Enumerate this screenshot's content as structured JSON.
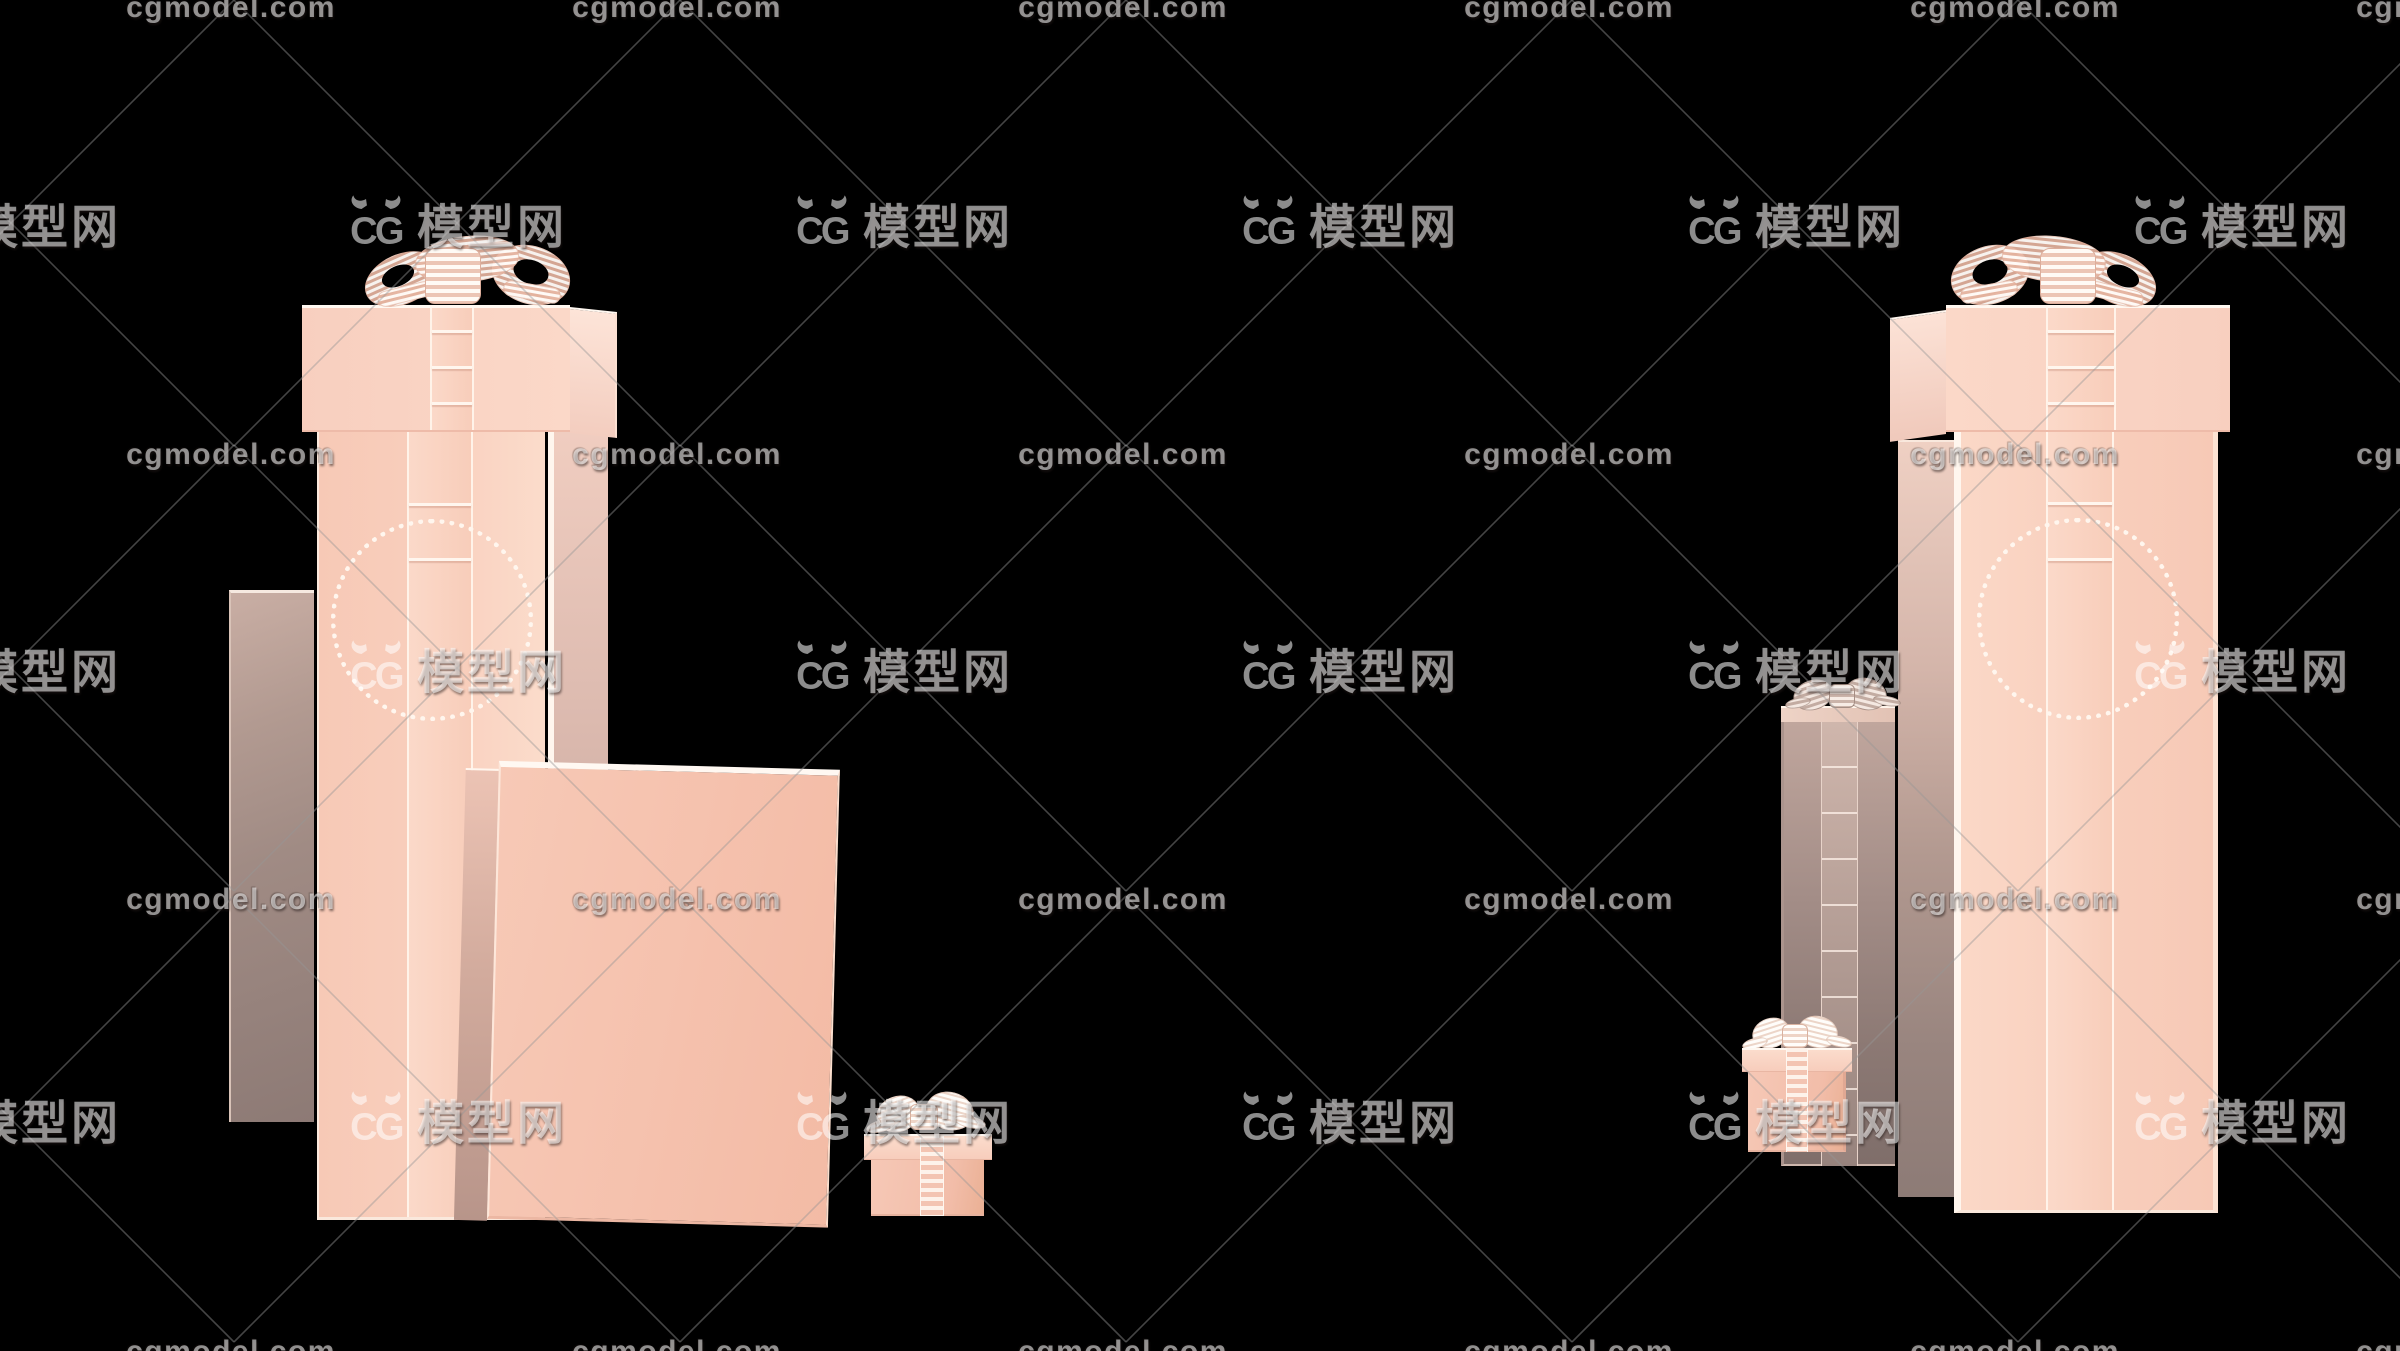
{
  "watermark": {
    "site_text": "cgmodel.com",
    "logo_monogram": "CG",
    "logo_text": "模型网",
    "fill_color": "rgba(255,255,255,0.55)",
    "line_color": "rgba(150,150,150,0.45)",
    "grid": {
      "canvas_w": 2400,
      "canvas_h": 1351,
      "col_step": 446,
      "cols": 6,
      "text_col_start": 231,
      "logo_col_start": 11,
      "text_rows": [
        8,
        455,
        900,
        1352
      ],
      "logo_rows": [
        223,
        668,
        1119
      ],
      "half_cell_h": 223
    }
  },
  "scene": {
    "background": "#000000",
    "objects_left_group": [
      "backdrop-panel",
      "tall-gift-box-with-bow",
      "flat-gift-box",
      "mini-gift-box"
    ],
    "objects_right_group": [
      "gray-gift-box-with-bow",
      "tall-gift-box-with-bow",
      "mini-gift-box"
    ]
  },
  "colors": {
    "background": "#000000",
    "pink_face": "#f8cdbb",
    "pink_light": "#fbdccb",
    "pink_deep": "#f2bca7",
    "mauve_side": "#b8998f",
    "gray_panel": "#9b8884",
    "edge_white": "#fff6ee",
    "ribbon_stripe": "#e2b2a0",
    "bow_white": "#fdf3ec"
  }
}
